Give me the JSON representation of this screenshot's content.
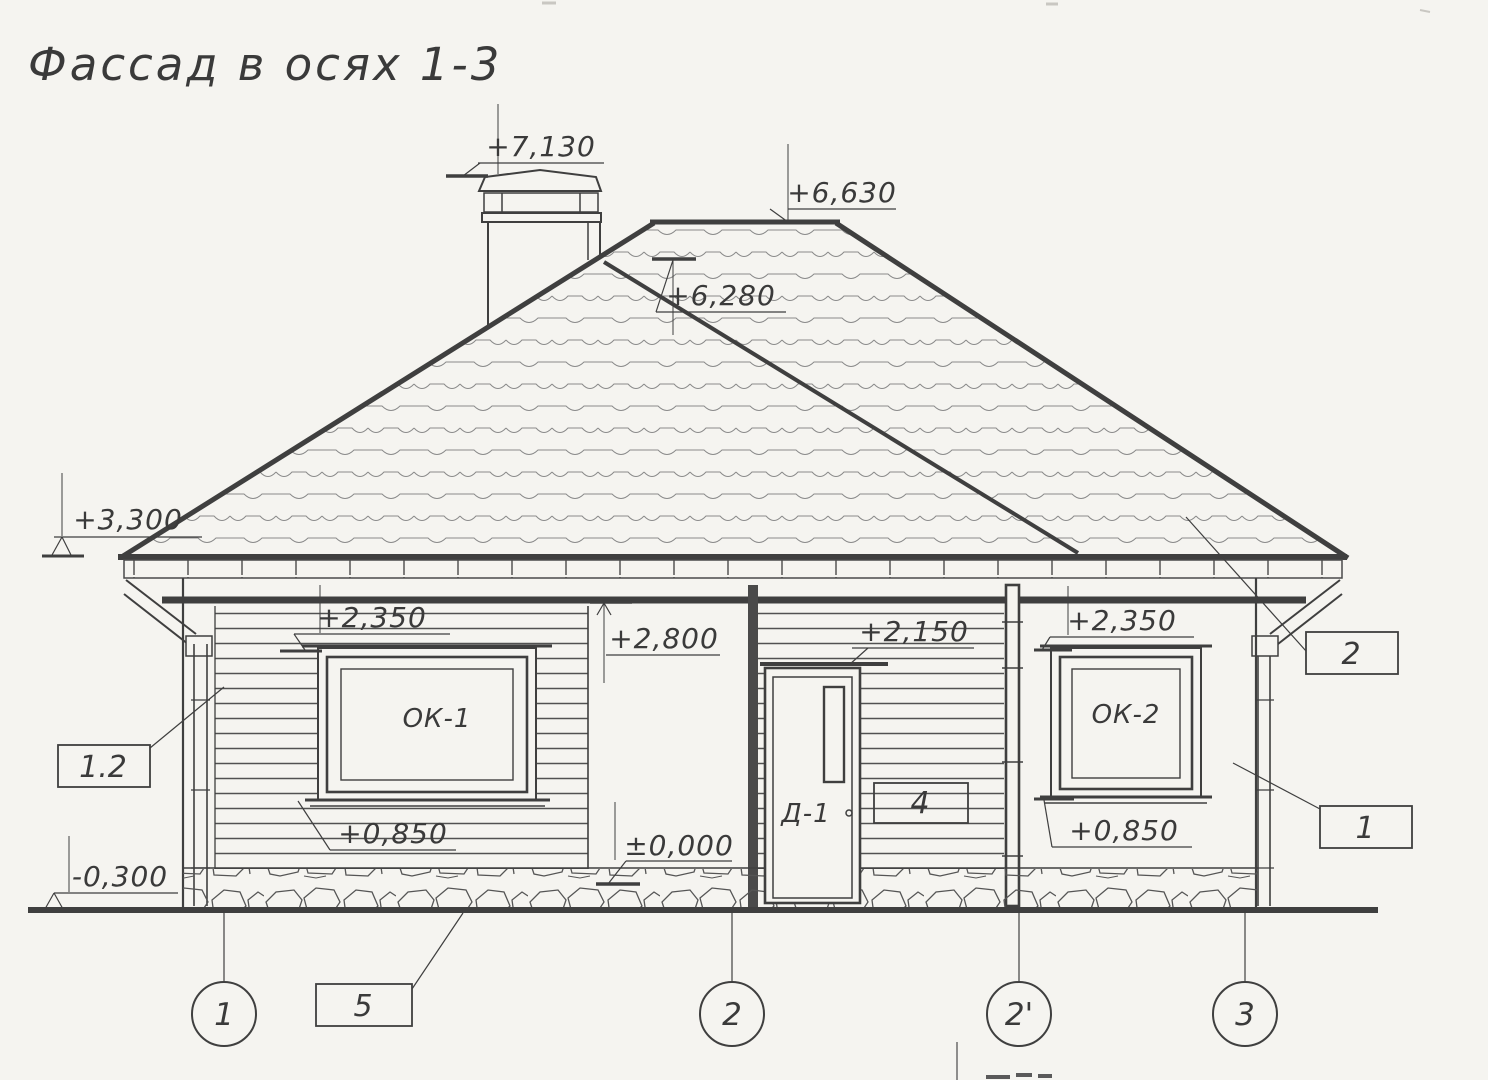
{
  "title": "Фассад в осях 1-3",
  "colors": {
    "ink": "#3f3f3f",
    "paper": "#f5f4f0"
  },
  "drawing": {
    "elevation_marks": {
      "chimney_top": "+7,130",
      "ridge": "+6,630",
      "roof_slope": "+6,280",
      "eaves": "+3,300",
      "window_head_left": "+2,350",
      "porch_ceiling": "+2,800",
      "door_head": "+2,150",
      "window_head_right": "+2,350",
      "window_sill_left": "+0,850",
      "floor": "±0,000",
      "window_sill_right": "+0,850",
      "ground": "-0,300"
    },
    "component_labels": {
      "window_left": "ОК-1",
      "door": "Д-1",
      "window_right": "ОК-2"
    },
    "callouts": {
      "wall_corner": "1.2",
      "foundation": "5",
      "door_wall": "4",
      "roof": "2",
      "right_wall": "1"
    },
    "axes": [
      "1",
      "2",
      "2'",
      "3"
    ]
  }
}
